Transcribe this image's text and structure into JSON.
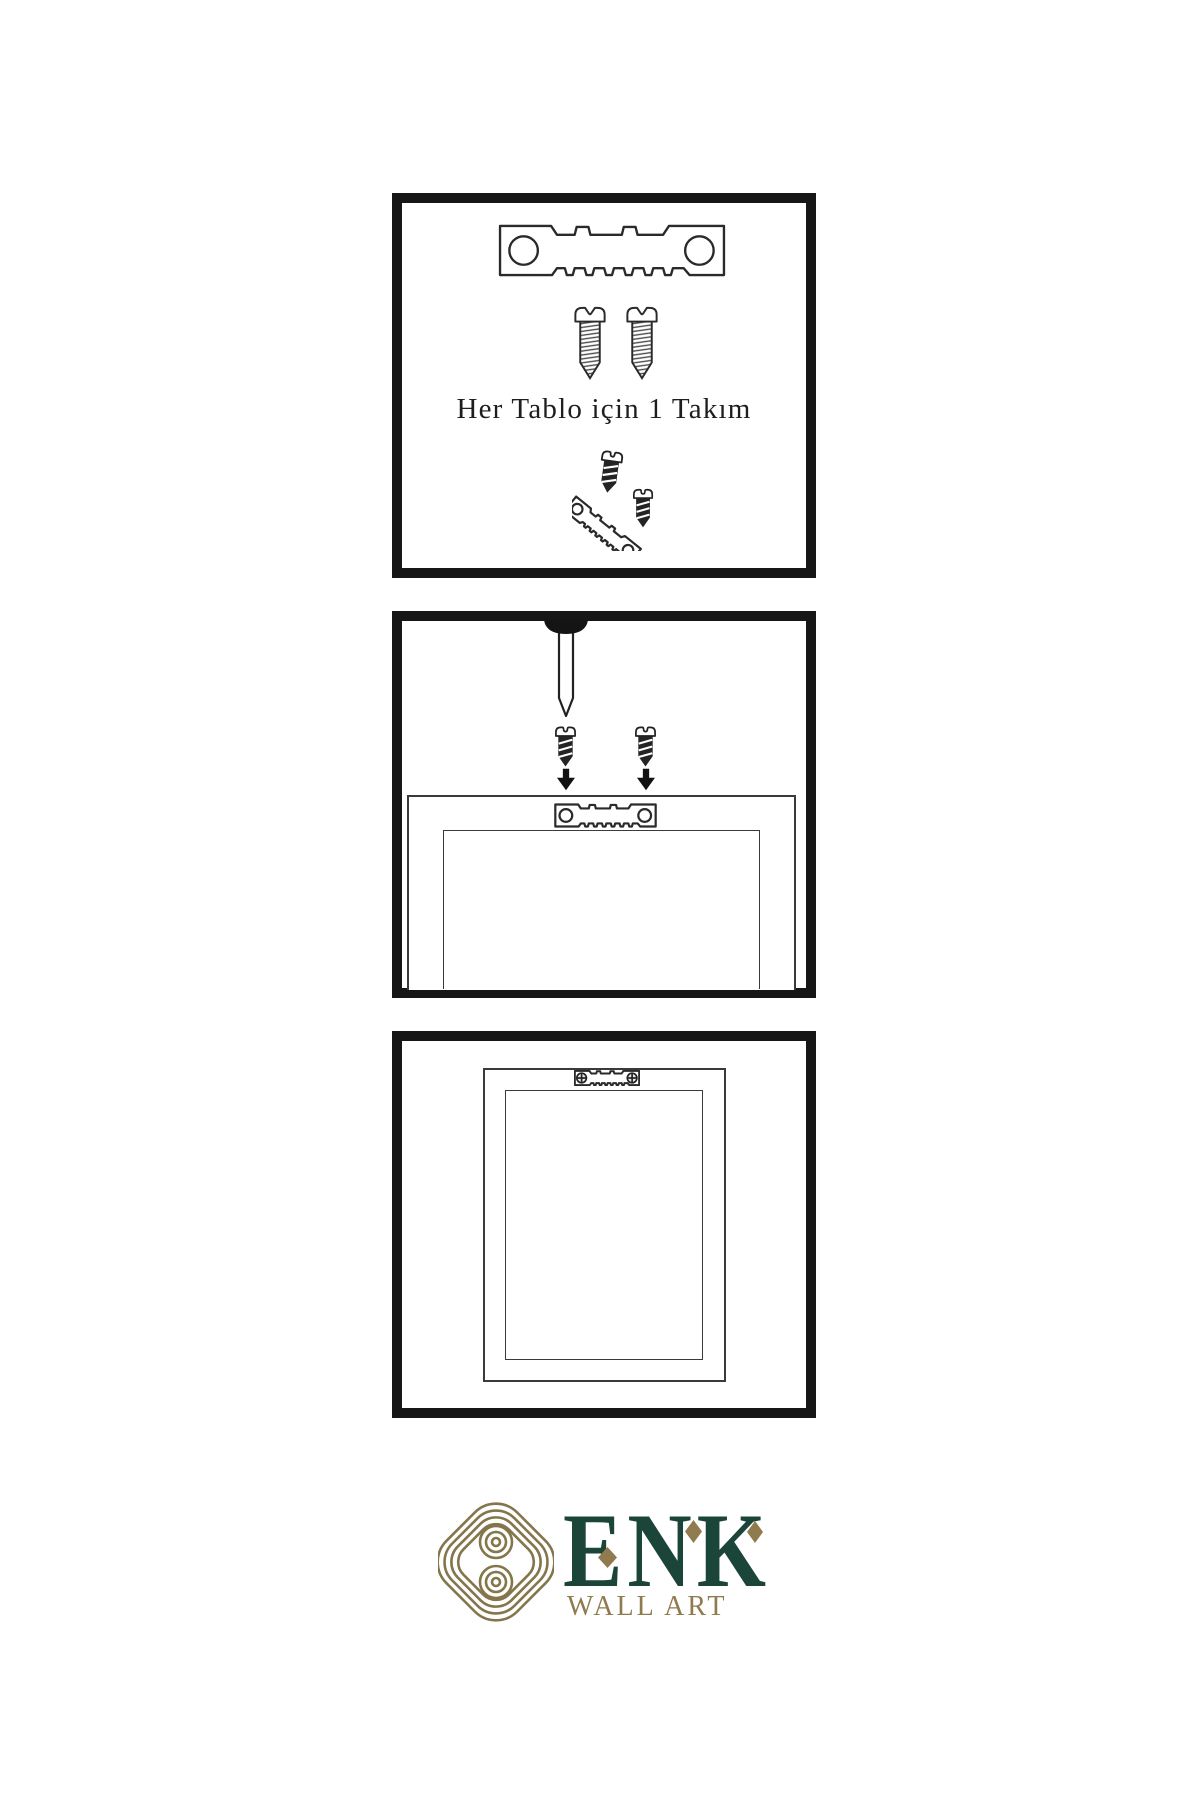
{
  "sheet": {
    "kind": "wall-art-mounting-instructions",
    "background": "#ffffff",
    "line_color": "#2a2a2a",
    "panel_border_color": "#161616"
  },
  "steps": {
    "step1": {
      "name": "hardware-kit-contents",
      "caption": "Her Tablo için 1 Takım",
      "items": [
        "sawtooth-hanger",
        "mounting-screw",
        "mounting-screw",
        "screw-with-angled-hanger"
      ]
    },
    "step2": {
      "name": "attach-hanger-to-frame-back",
      "items": [
        "wall-nail",
        "mounting-screw",
        "mounting-screw",
        "down-arrow",
        "down-arrow",
        "sawtooth-hanger",
        "frame-back"
      ]
    },
    "step3": {
      "name": "frame-hung-on-wall",
      "items": [
        "framed-artwork-back",
        "installed-sawtooth-hanger"
      ]
    }
  },
  "logo": {
    "title": "ENK",
    "subtitle": "WALL ART",
    "green": "#1B4538",
    "gold": "#8F7B4D",
    "knot_gold": "#85754A"
  }
}
